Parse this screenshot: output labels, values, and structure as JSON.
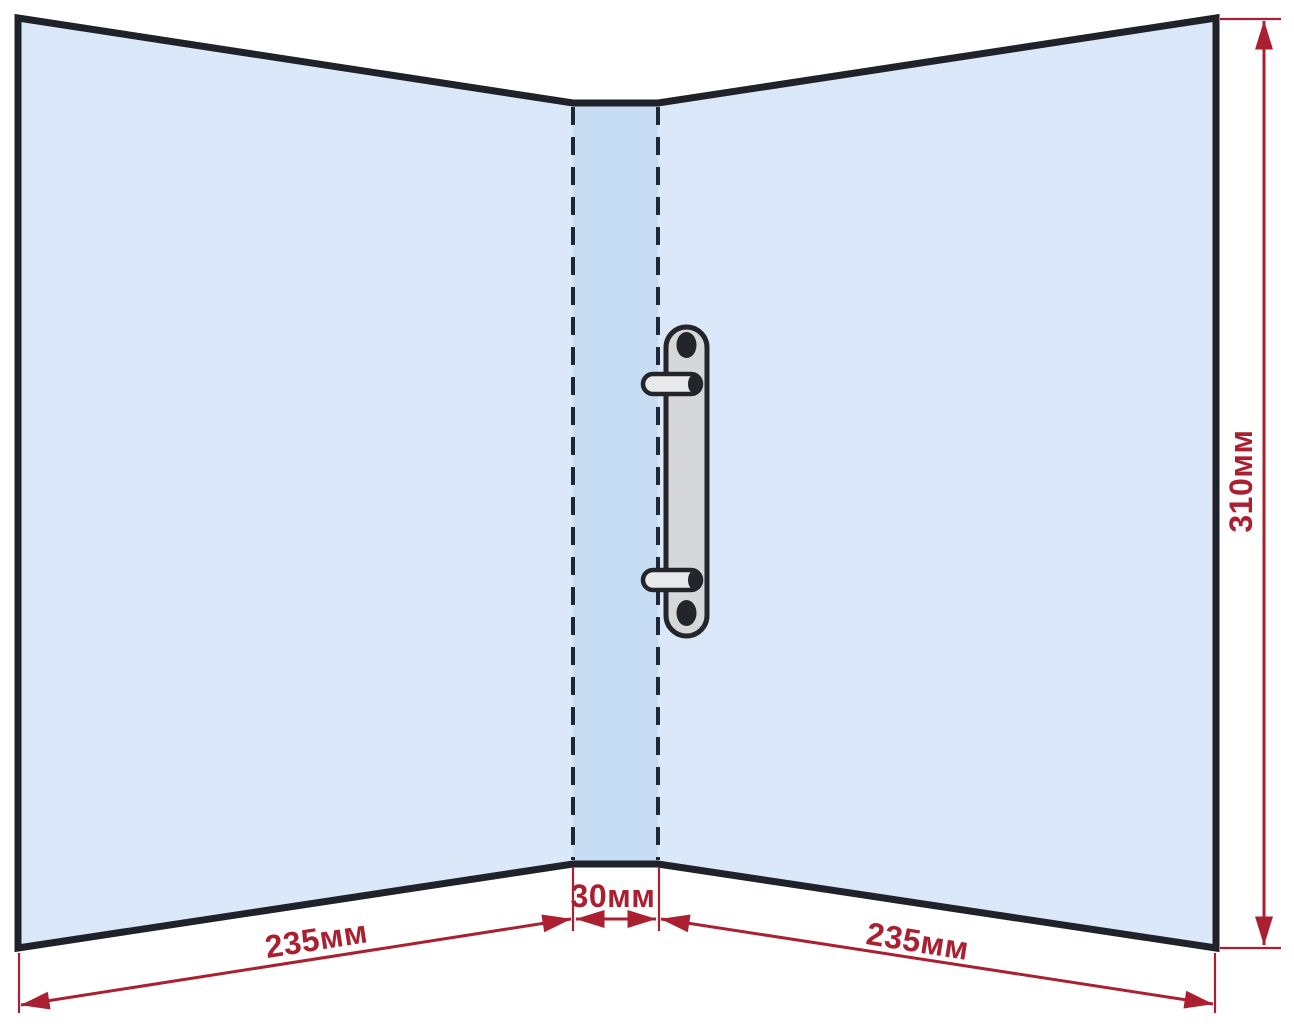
{
  "labels": {
    "left_width": "235мм",
    "spine_width": "30мм",
    "right_width": "235мм",
    "height": "310мм"
  },
  "colors": {
    "outline": "#1f2228",
    "fold_line": "#1d2836",
    "dimension_red": "#aa2031",
    "cover_blue": "#dbe8fa",
    "spine_blue": "#c7ddf3",
    "mechanism_gray": "#d6d7d9",
    "mechanism_outline": "#24242b",
    "background": "#ffffff"
  }
}
